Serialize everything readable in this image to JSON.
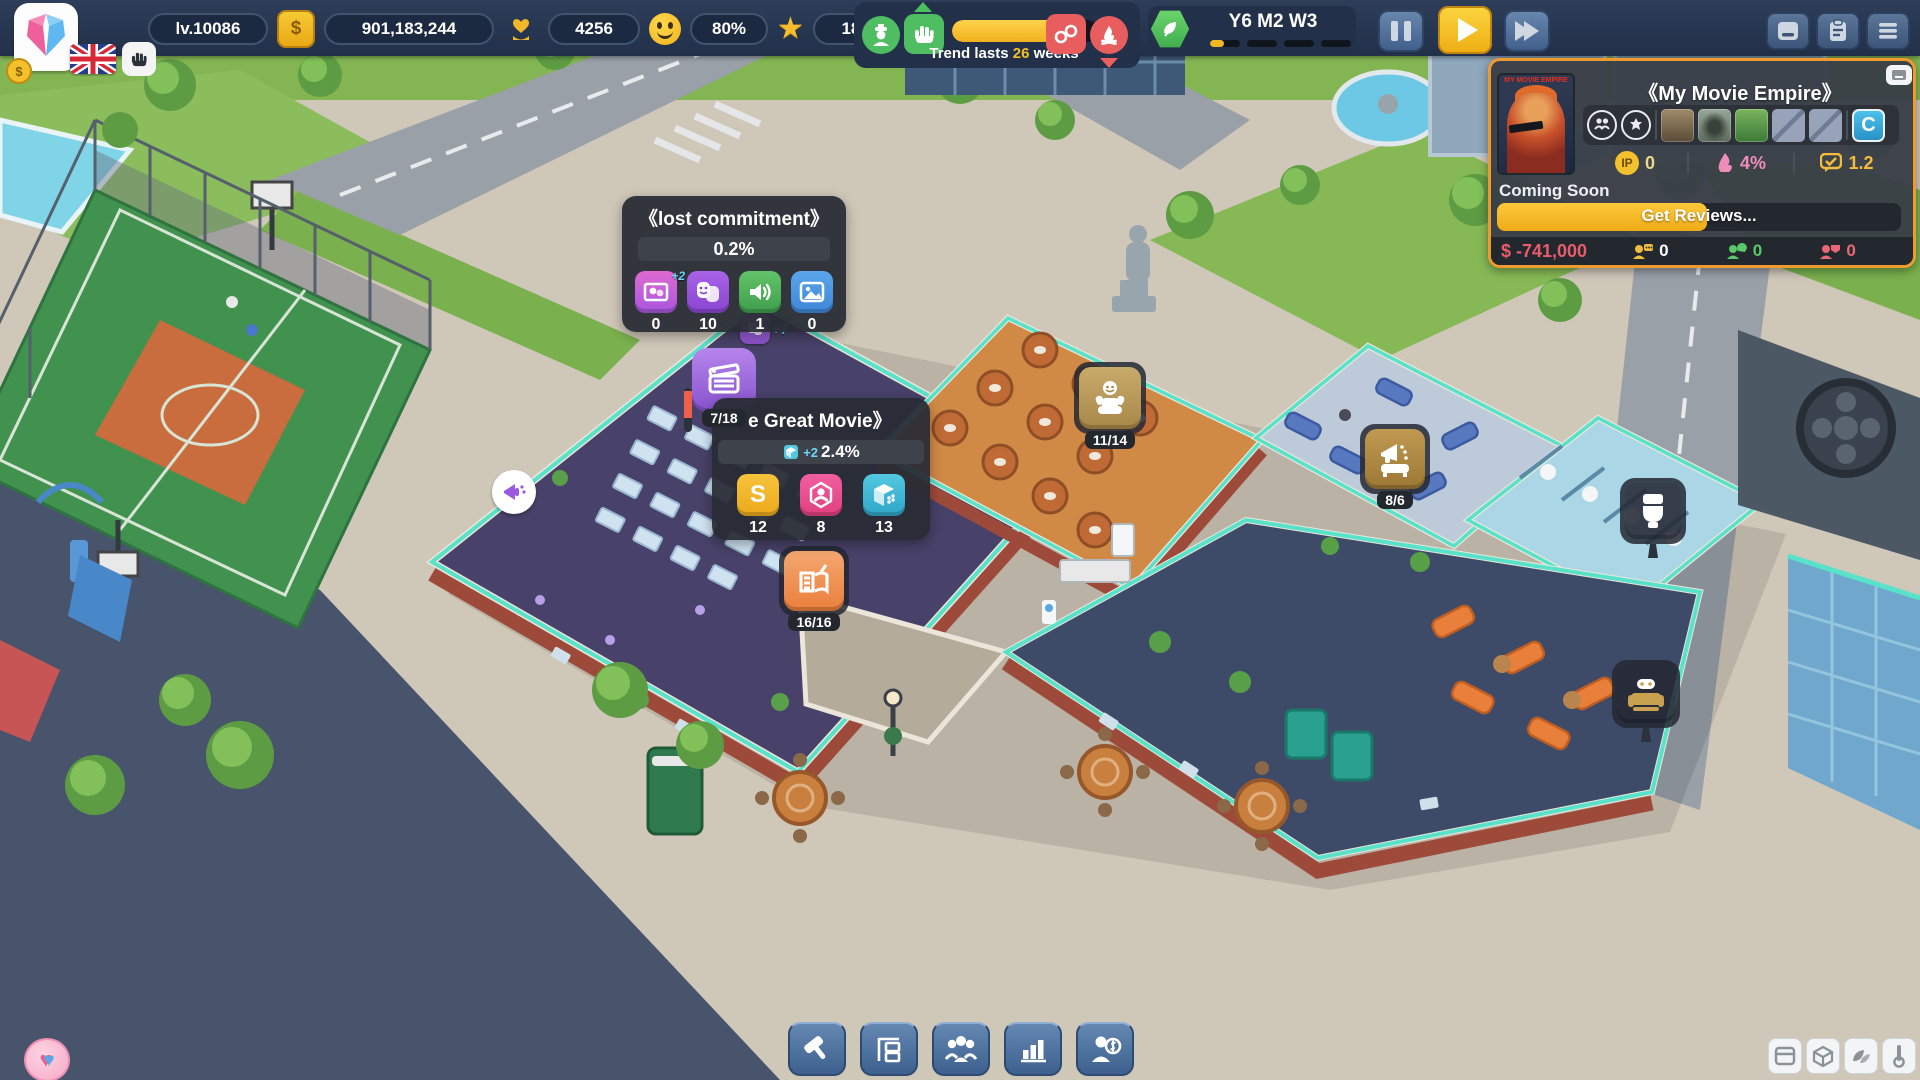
{
  "hud": {
    "level": "lv.10086",
    "money": "901,183,244",
    "fans": "4256",
    "happiness": "80%",
    "stars": "18"
  },
  "trend": {
    "label_before": "Trend lasts ",
    "weeks": "26",
    "label_after": " weeks",
    "bar_pct": 78
  },
  "date": {
    "label": "Y6 M2 W3",
    "week_pct": 45
  },
  "movie_panel": {
    "title": "《My Movie Empire》",
    "poster_title": "MY MOVIE EMPIRE",
    "slot_letter": "C",
    "ip_label": "IP",
    "ip": "0",
    "heat": "4%",
    "rating": "1.2",
    "status": "Coming Soon",
    "action": "Get Reviews...",
    "action_pct": 52,
    "balance": "$ -741,000",
    "viewers": "0",
    "positive": "0",
    "negative": "0"
  },
  "trend_tooltip": {
    "title": "《lost commitment》",
    "share": "0.2%",
    "stats": [
      {
        "icon": "drama-show-icon",
        "badge": "+2",
        "value": "0"
      },
      {
        "icon": "drama-masks-icon",
        "value": "10"
      },
      {
        "icon": "audio-icon",
        "value": "1"
      },
      {
        "icon": "image-icon",
        "value": "0"
      }
    ]
  },
  "movie_tooltip": {
    "title": "e Great Movie》",
    "boost": "+2",
    "share": "2.4%",
    "s_glyph": "S",
    "stats": [
      {
        "icon": "studio-icon",
        "value": "12"
      },
      {
        "icon": "casting-icon",
        "value": "8"
      },
      {
        "icon": "set-icon",
        "value": "13"
      }
    ]
  },
  "rooms": {
    "filming": "7/18",
    "script": "16/16",
    "casting": "11/14",
    "marketing": "8/6"
  },
  "scene": {
    "masks_boost": "+7"
  },
  "icons": {
    "star": "★",
    "heart": "♥",
    "dollar": "$"
  },
  "colors": {
    "accent_orange": "#ef9a2e",
    "bar_yellow": "#f2b722",
    "teal_outline": "#57e2c9",
    "panel_bg": "#3a3f47",
    "topbar_bg": "#22304a",
    "negative_red": "#e85c6c",
    "positive_green": "#58c868",
    "purple": "#9a5ae0",
    "pink": "#f05fa0",
    "cyan": "#53c8e0"
  }
}
